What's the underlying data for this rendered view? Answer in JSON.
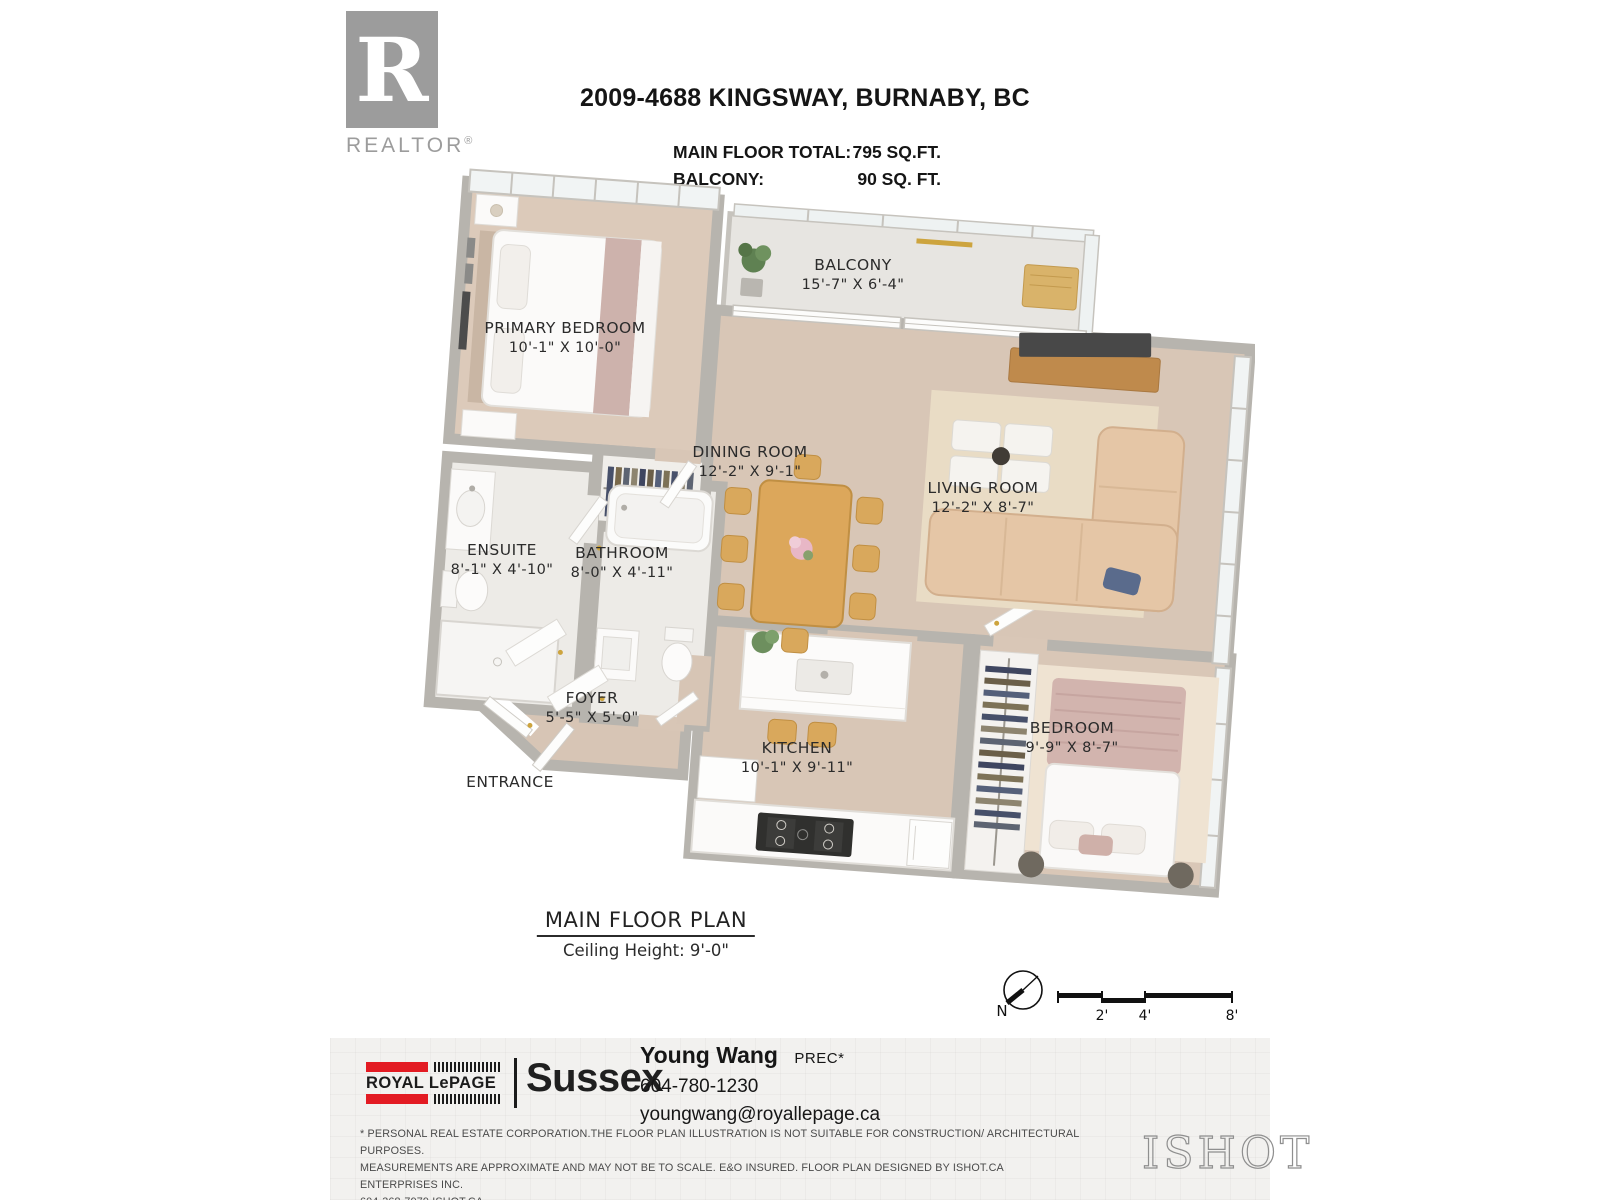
{
  "header": {
    "realtor_logo": {
      "letter": "R",
      "label": "REALTOR",
      "mark": "®"
    },
    "title": "2009-4688 KINGSWAY, BURNABY, BC",
    "area_rows": [
      {
        "label": "MAIN FLOOR TOTAL:",
        "value": "795 SQ.FT."
      },
      {
        "label": "BALCONY:",
        "value": "90 SQ. FT."
      }
    ]
  },
  "floor_plan": {
    "rooms": [
      {
        "name": "BALCONY",
        "dims": "15'-7\" X 6'-4\""
      },
      {
        "name": "PRIMARY BEDROOM",
        "dims": "10'-1\" X 10'-0\""
      },
      {
        "name": "DINING ROOM",
        "dims": "12'-2\" X 9'-1\""
      },
      {
        "name": "LIVING ROOM",
        "dims": "12'-2\" X 8'-7\""
      },
      {
        "name": "ENSUITE",
        "dims": "8'-1\" X 4'-10\""
      },
      {
        "name": "BATHROOM",
        "dims": "8'-0\" X 4'-11\""
      },
      {
        "name": "FOYER",
        "dims": "5'-5\" X 5'-0\""
      },
      {
        "name": "ENTRANCE",
        "dims": ""
      },
      {
        "name": "KITCHEN",
        "dims": "10'-1\" X 9'-11\""
      },
      {
        "name": "BEDROOM",
        "dims": "9'-9\" X 8'-7\""
      }
    ],
    "caption": {
      "title": "MAIN FLOOR PLAN",
      "subtitle": "Ceiling Height: 9'-0\""
    },
    "compass": {
      "north_label": "N"
    },
    "scale_bar": {
      "ticks": [
        "2'",
        "4'",
        "8'"
      ]
    }
  },
  "footer": {
    "brokerage": {
      "brand": "ROYAL LePAGE",
      "office": "Sussex"
    },
    "agent": {
      "name": "Young Wang",
      "designation": "PREC*",
      "phone": "604-780-1230",
      "email": "youngwang@royallepage.ca"
    },
    "disclaimer_lines": [
      "* PERSONAL REAL ESTATE CORPORATION.THE FLOOR PLAN ILLUSTRATION IS NOT SUITABLE FOR CONSTRUCTION/ ARCHITECTURAL PURPOSES.",
      "MEASUREMENTS ARE APPROXIMATE AND MAY NOT BE TO SCALE. E&O INSURED. FLOOR PLAN DESIGNED BY ISHOT.CA ENTERPRISES INC.",
      "604-368-7979  ISHOT.CA"
    ],
    "designer_logo": "ISHOT"
  },
  "colors": {
    "brand_red": "#e31b23",
    "wall_gray": "#b7b4ae",
    "wood_floor": "#d8c6b6",
    "tile_floor": "#edebe7",
    "living_rug": "#e9dcc5",
    "accent_wood": "#d9a85c",
    "text_dark": "#2d2d2d"
  }
}
